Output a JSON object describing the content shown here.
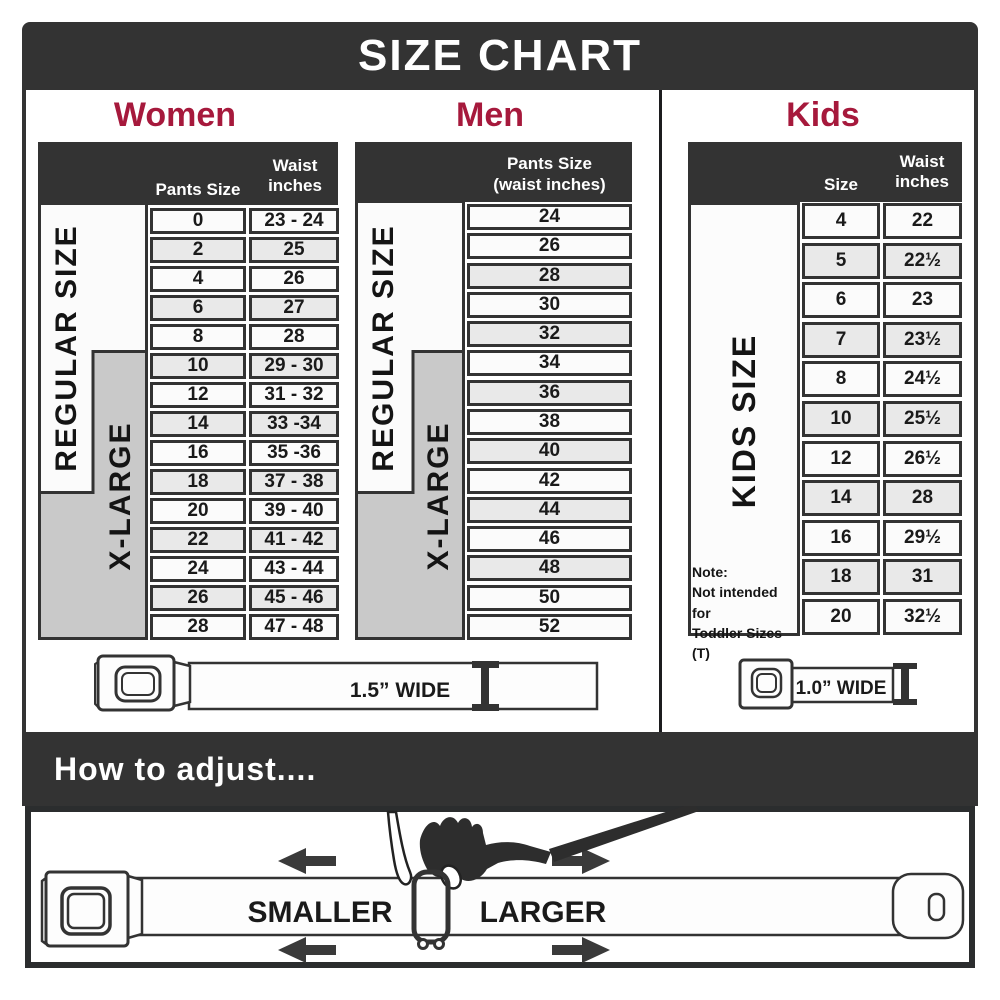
{
  "title": "SIZE CHART",
  "colors": {
    "dark": "#333333",
    "accent": "#a6193c",
    "gray_band": "#c9c9c9",
    "row_light": "#fbfbfb",
    "row_shaded": "#e9e9e9"
  },
  "women": {
    "heading": "Women",
    "size_label": "REGULAR SIZE",
    "xl_label": "X-LARGE",
    "headers": {
      "col1": "Pants Size",
      "col2": "Waist inches"
    },
    "rows": [
      {
        "size": "0",
        "waist": "23 - 24",
        "shaded": false
      },
      {
        "size": "2",
        "waist": "25",
        "shaded": true
      },
      {
        "size": "4",
        "waist": "26",
        "shaded": false
      },
      {
        "size": "6",
        "waist": "27",
        "shaded": true
      },
      {
        "size": "8",
        "waist": "28",
        "shaded": false
      },
      {
        "size": "10",
        "waist": "29 - 30",
        "shaded": true
      },
      {
        "size": "12",
        "waist": "31 - 32",
        "shaded": false
      },
      {
        "size": "14",
        "waist": "33 -34",
        "shaded": true
      },
      {
        "size": "16",
        "waist": "35 -36",
        "shaded": false
      },
      {
        "size": "18",
        "waist": "37 - 38",
        "shaded": true
      },
      {
        "size": "20",
        "waist": "39 - 40",
        "shaded": false
      },
      {
        "size": "22",
        "waist": "41 - 42",
        "shaded": true
      },
      {
        "size": "24",
        "waist": "43 - 44",
        "shaded": false
      },
      {
        "size": "26",
        "waist": "45 - 46",
        "shaded": true
      },
      {
        "size": "28",
        "waist": "47 - 48",
        "shaded": false
      }
    ]
  },
  "men": {
    "heading": "Men",
    "size_label": "REGULAR SIZE",
    "xl_label": "X-LARGE",
    "headers": {
      "line1": "Pants Size",
      "line2": "(waist inches)"
    },
    "rows": [
      {
        "size": "24",
        "shaded": false
      },
      {
        "size": "26",
        "shaded": false
      },
      {
        "size": "28",
        "shaded": true
      },
      {
        "size": "30",
        "shaded": false
      },
      {
        "size": "32",
        "shaded": true
      },
      {
        "size": "34",
        "shaded": false
      },
      {
        "size": "36",
        "shaded": true
      },
      {
        "size": "38",
        "shaded": false
      },
      {
        "size": "40",
        "shaded": true
      },
      {
        "size": "42",
        "shaded": false
      },
      {
        "size": "44",
        "shaded": true
      },
      {
        "size": "46",
        "shaded": false
      },
      {
        "size": "48",
        "shaded": true
      },
      {
        "size": "50",
        "shaded": false
      },
      {
        "size": "52",
        "shaded": false
      }
    ]
  },
  "kids": {
    "heading": "Kids",
    "size_label": "KIDS SIZE",
    "headers": {
      "col1": "Size",
      "col2": "Waist inches"
    },
    "rows": [
      {
        "size": "4",
        "waist": "22",
        "shaded": false
      },
      {
        "size": "5",
        "waist": "22½",
        "shaded": true
      },
      {
        "size": "6",
        "waist": "23",
        "shaded": false
      },
      {
        "size": "7",
        "waist": "23½",
        "shaded": true
      },
      {
        "size": "8",
        "waist": "24½",
        "shaded": false
      },
      {
        "size": "10",
        "waist": "25½",
        "shaded": true
      },
      {
        "size": "12",
        "waist": "26½",
        "shaded": false
      },
      {
        "size": "14",
        "waist": "28",
        "shaded": true
      },
      {
        "size": "16",
        "waist": "29½",
        "shaded": false
      },
      {
        "size": "18",
        "waist": "31",
        "shaded": true
      },
      {
        "size": "20",
        "waist": "32½",
        "shaded": false
      }
    ],
    "note": {
      "line1": "Note:",
      "line2": "Not intended for",
      "line3": "Toddler Sizes (T)"
    }
  },
  "belts": {
    "adult": "1.5” WIDE",
    "kids": "1.0” WIDE"
  },
  "footer": {
    "heading": "How to adjust....",
    "smaller": "SMALLER",
    "larger": "LARGER"
  }
}
